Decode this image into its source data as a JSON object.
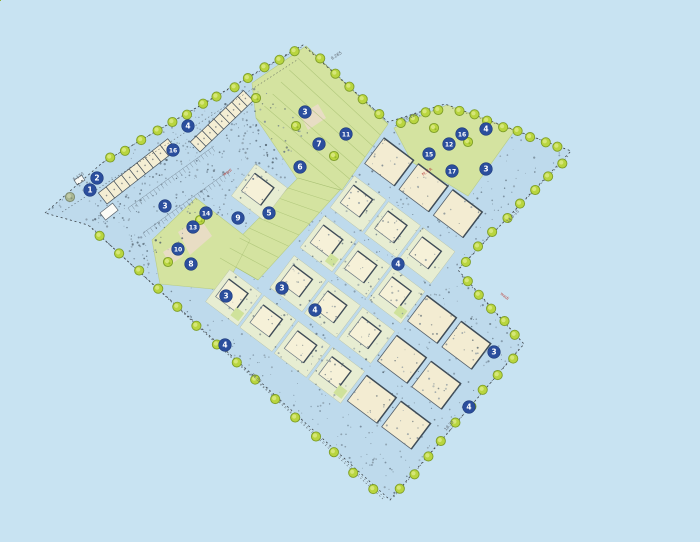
{
  "plan": {
    "name": "residential-site-plan",
    "colors": {
      "background": "#c8e3f2",
      "site_fill": "#bedaec",
      "green": "#d4e3a0",
      "green_hatch": "#a3bd6d",
      "path_pink": "#e9dcc6",
      "plot_base": "#e7edd2",
      "plot_stroke": "#b7c2a8",
      "house_fill": "#f6f1d8",
      "house_stroke": "#6a7680",
      "wall_dark": "#3f4c57",
      "apartment_fill": "#f3ecd2",
      "apartment_stroke": "#55606a",
      "terrace_fill": "#f4eed4",
      "terrace_stroke": "#47525c",
      "tree_fill": "#b9d53f",
      "tree_stroke": "#7e9e28",
      "tree_inner": "#d9e87f",
      "tree_olive": "#a9b692",
      "tree_olive_stroke": "#7d8a6f",
      "tree_olive_inner": "#c3cdaa",
      "badge_fill": "#2b4e9d",
      "badge_stroke": "#1d3a7a",
      "boundary": "#3c4247",
      "speckle": [
        "#5f7080",
        "#7c8c98",
        "#4a5a66"
      ]
    },
    "outline": [
      [
        45,
        213
      ],
      [
        102,
        163
      ],
      [
        303,
        45
      ],
      [
        388,
        122
      ],
      [
        445,
        104
      ],
      [
        571,
        151
      ],
      [
        458,
        270
      ],
      [
        524,
        344
      ],
      [
        390,
        500
      ],
      [
        88,
        225
      ]
    ],
    "extra_dashed": [
      [
        [
          62,
          212
        ],
        [
          297,
          60
        ]
      ],
      [
        [
          100,
          236
        ],
        [
          385,
          498
        ]
      ]
    ],
    "greens": [
      {
        "pts": [
          [
            252,
            83
          ],
          [
            306,
            46
          ],
          [
            388,
            124
          ],
          [
            342,
            190
          ],
          [
            298,
            180
          ],
          [
            256,
            118
          ]
        ]
      },
      {
        "pts": [
          [
            298,
            178
          ],
          [
            340,
            190
          ],
          [
            258,
            280
          ],
          [
            220,
            258
          ]
        ]
      },
      {
        "pts": [
          [
            152,
            240
          ],
          [
            196,
            198
          ],
          [
            250,
            240
          ],
          [
            224,
            290
          ],
          [
            160,
            284
          ]
        ]
      },
      {
        "pts": [
          [
            394,
            128
          ],
          [
            447,
            105
          ],
          [
            515,
            130
          ],
          [
            468,
            196
          ],
          [
            412,
            162
          ]
        ]
      }
    ],
    "paths": [
      {
        "pts": [
          [
            178,
            232
          ],
          [
            200,
            218
          ],
          [
            212,
            236
          ],
          [
            190,
            255
          ]
        ]
      },
      {
        "pts": [
          [
            163,
            252
          ],
          [
            176,
            244
          ],
          [
            183,
            256
          ],
          [
            170,
            265
          ]
        ]
      },
      {
        "pts": [
          [
            300,
            115
          ],
          [
            318,
            104
          ],
          [
            326,
            118
          ],
          [
            308,
            130
          ]
        ]
      }
    ],
    "hatch_bands": [
      {
        "a1": [
          298,
          178
        ],
        "a2": [
          220,
          258
        ],
        "b1": [
          340,
          190
        ],
        "b2": [
          258,
          280
        ],
        "n": 8
      },
      {
        "a1": [
          306,
          46
        ],
        "a2": [
          256,
          118
        ],
        "b1": [
          388,
          124
        ],
        "b2": [
          342,
          190
        ],
        "n": 6
      }
    ],
    "tree_edges": [
      {
        "x1": 102,
        "y1": 163,
        "x2": 303,
        "y2": 46,
        "count": 13
      },
      {
        "x1": 312,
        "y1": 52,
        "x2": 386,
        "y2": 120,
        "count": 5
      },
      {
        "x1": 395,
        "y1": 126,
        "x2": 443,
        "y2": 106,
        "count": 4
      },
      {
        "x1": 452,
        "y1": 108,
        "x2": 566,
        "y2": 149,
        "count": 8
      },
      {
        "x1": 568,
        "y1": 156,
        "x2": 459,
        "y2": 268,
        "count": 8
      },
      {
        "x1": 462,
        "y1": 276,
        "x2": 521,
        "y2": 341,
        "count": 5
      },
      {
        "x1": 519,
        "y1": 349,
        "x2": 393,
        "y2": 498,
        "count": 9
      },
      {
        "x1": 383,
        "y1": 499,
        "x2": 90,
        "y2": 226,
        "count": 15
      }
    ],
    "interior_trees": [
      {
        "x": 256,
        "y": 98
      },
      {
        "x": 296,
        "y": 126
      },
      {
        "x": 334,
        "y": 156
      },
      {
        "x": 434,
        "y": 128
      },
      {
        "x": 468,
        "y": 142
      },
      {
        "x": 200,
        "y": 220
      },
      {
        "x": 168,
        "y": 262
      },
      {
        "x": 70,
        "y": 197,
        "olive": true
      }
    ],
    "terrace_rows": [
      {
        "x": 200,
        "y": 152,
        "angle": -44,
        "len": 74,
        "w": 14,
        "units": 9
      },
      {
        "x": 107,
        "y": 204,
        "angle": -38,
        "len": 88,
        "w": 14,
        "units": 9
      }
    ],
    "small_buildings": [
      {
        "x": 100,
        "y": 213,
        "w": 16,
        "h": 9,
        "rot": -38
      },
      {
        "x": 74,
        "y": 180,
        "w": 9,
        "h": 6,
        "rot": -33
      }
    ],
    "parking_combs": [
      {
        "x1": 128,
        "y1": 208,
        "x2": 214,
        "y2": 146,
        "tick": 5,
        "step": 4.5
      },
      {
        "x1": 143,
        "y1": 233,
        "x2": 230,
        "y2": 170,
        "tick": 5,
        "step": 4.5
      }
    ],
    "parking_zone": [
      [
        80,
        215
      ],
      [
        255,
        78
      ],
      [
        315,
        135
      ],
      [
        150,
        266
      ]
    ],
    "field": {
      "ax": 390,
      "ay": 125,
      "angle": 37,
      "row0": 12,
      "rowPitch": 50,
      "rows": 8,
      "col0": -170,
      "colPitch": 43,
      "cols": 17,
      "plot": 40,
      "apartment_x": 115
    },
    "badges": [
      {
        "n": "1",
        "x": 90,
        "y": 190
      },
      {
        "n": "2",
        "x": 97,
        "y": 178
      },
      {
        "n": "3",
        "x": 165,
        "y": 206
      },
      {
        "n": "4",
        "x": 188,
        "y": 126
      },
      {
        "n": "16",
        "x": 173,
        "y": 150
      },
      {
        "n": "3",
        "x": 305,
        "y": 112
      },
      {
        "n": "14",
        "x": 206,
        "y": 213
      },
      {
        "n": "13",
        "x": 193,
        "y": 227
      },
      {
        "n": "9",
        "x": 238,
        "y": 218
      },
      {
        "n": "5",
        "x": 269,
        "y": 213
      },
      {
        "n": "10",
        "x": 178,
        "y": 249
      },
      {
        "n": "8",
        "x": 191,
        "y": 264
      },
      {
        "n": "3",
        "x": 226,
        "y": 296
      },
      {
        "n": "3",
        "x": 282,
        "y": 288
      },
      {
        "n": "4",
        "x": 315,
        "y": 310
      },
      {
        "n": "4",
        "x": 225,
        "y": 345
      },
      {
        "n": "4",
        "x": 398,
        "y": 264
      },
      {
        "n": "6",
        "x": 300,
        "y": 167
      },
      {
        "n": "7",
        "x": 319,
        "y": 144
      },
      {
        "n": "11",
        "x": 346,
        "y": 134
      },
      {
        "n": "15",
        "x": 429,
        "y": 154
      },
      {
        "n": "12",
        "x": 449,
        "y": 144
      },
      {
        "n": "16",
        "x": 462,
        "y": 134
      },
      {
        "n": "4",
        "x": 486,
        "y": 129
      },
      {
        "n": "17",
        "x": 452,
        "y": 171
      },
      {
        "n": "3",
        "x": 486,
        "y": 169
      },
      {
        "n": "3",
        "x": 494,
        "y": 352
      },
      {
        "n": "4",
        "x": 469,
        "y": 407
      }
    ],
    "dim_labels": [
      {
        "text": "28.135",
        "x": 404,
        "y": 121,
        "rot": -24
      },
      {
        "text": "14.8-15",
        "x": 508,
        "y": 223,
        "rot": -46
      },
      {
        "text": "24.52",
        "x": 251,
        "y": 375,
        "rot": 42
      },
      {
        "text": "18.35",
        "x": 446,
        "y": 431,
        "rot": -49
      },
      {
        "text": "9.265",
        "x": 332,
        "y": 60,
        "rot": -33
      },
      {
        "text": "5.170",
        "x": 74,
        "y": 181,
        "rot": -33
      }
    ],
    "red_labels": [
      {
        "text": "M.V.R",
        "x": 423,
        "y": 176,
        "rot": -33
      },
      {
        "text": "wadi",
        "x": 224,
        "y": 176,
        "rot": -33
      },
      {
        "text": "wadi",
        "x": 500,
        "y": 294,
        "rot": 40
      }
    ]
  }
}
